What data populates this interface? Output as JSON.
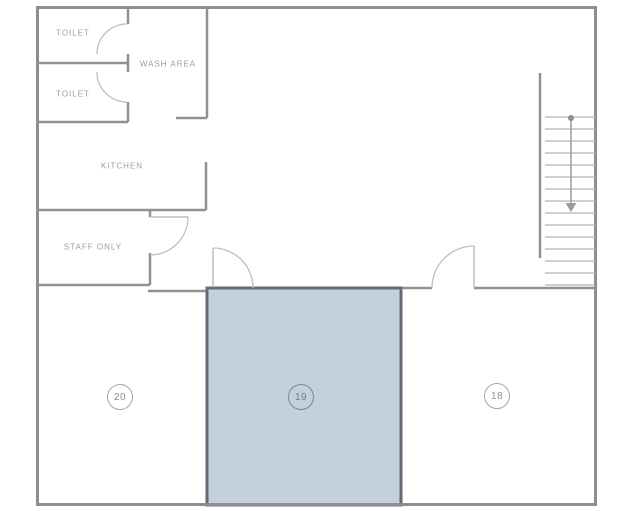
{
  "plan": {
    "title": "Floor plan",
    "rooms": {
      "toilet_top": {
        "label": "TOILET"
      },
      "toilet_bottom": {
        "label": "TOILET"
      },
      "wash_area": {
        "label": "WASH AREA"
      },
      "kitchen": {
        "label": "KITCHEN"
      },
      "staff_only": {
        "label": "STAFF ONLY"
      }
    },
    "units": [
      {
        "number": "20",
        "highlighted": false
      },
      {
        "number": "19",
        "highlighted": true
      },
      {
        "number": "18",
        "highlighted": false
      }
    ],
    "colors": {
      "wall": "#8e8e8e",
      "door_arc": "#bdbdbd",
      "stair_step": "#bfbfbf",
      "label_text": "#9d9d9d",
      "highlight_fill": "#c3d0de",
      "highlight_border": "#626c76"
    }
  }
}
